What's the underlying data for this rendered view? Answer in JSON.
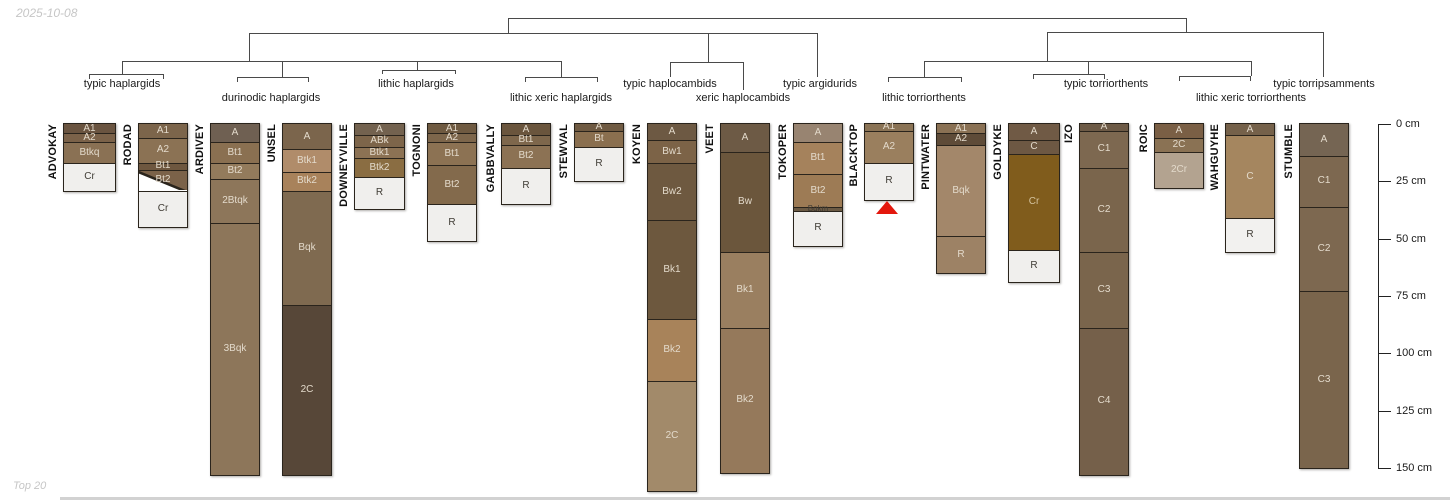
{
  "watermarks": {
    "top_left": "2025-10-08",
    "bottom_left": "Top 20"
  },
  "chart_data": {
    "type": "soil-horizon-dendrogram",
    "depth_axis": {
      "unit": "cm",
      "min": 0,
      "max": 150,
      "ticks": [
        {
          "cm": 0,
          "label": "0 cm"
        },
        {
          "cm": 25,
          "label": "25 cm"
        },
        {
          "cm": 50,
          "label": "50 cm"
        },
        {
          "cm": 75,
          "label": "75 cm"
        },
        {
          "cm": 100,
          "label": "100 cm"
        },
        {
          "cm": 125,
          "label": "125 cm"
        },
        {
          "cm": 150,
          "label": "150 cm"
        }
      ]
    },
    "groups": [
      {
        "label": "typic haplargids",
        "cx": 122,
        "row": 1,
        "series": [
          "ADVOKAY",
          "RODAD"
        ]
      },
      {
        "label": "durinodic haplargids",
        "cx": 271,
        "row": 2,
        "series": [
          "ARDIVEY",
          "UNSEL"
        ]
      },
      {
        "label": "lithic haplargids",
        "cx": 416,
        "row": 1,
        "series": [
          "DOWNEYVILLE",
          "TOGNONI"
        ]
      },
      {
        "label": "lithic xeric haplargids",
        "cx": 561,
        "row": 2,
        "series": [
          "GABBVALLY",
          "STEWVAL"
        ]
      },
      {
        "label": "typic haplocambids",
        "cx": 670,
        "row": 1,
        "series": [
          "KOYEN"
        ]
      },
      {
        "label": "xeric haplocambids",
        "cx": 743,
        "row": 2,
        "series": [
          "VEET"
        ]
      },
      {
        "label": "typic argidurids",
        "cx": 820,
        "row": 1,
        "series": [
          "TOKOPER"
        ]
      },
      {
        "label": "lithic torriorthents",
        "cx": 924,
        "row": 2,
        "series": [
          "BLACKTOP",
          "PINTWATER"
        ]
      },
      {
        "label": "typic torriorthents",
        "cx": 1106,
        "row": 1,
        "series": [
          "GOLDYKE",
          "IZO"
        ]
      },
      {
        "label": "lithic xeric torriorthents",
        "cx": 1251,
        "row": 2,
        "series": [
          "ROIC",
          "WAHGUYHE"
        ]
      },
      {
        "label": "typic torripsamments",
        "cx": 1324,
        "row": 1,
        "series": [
          "STUMBLE"
        ]
      }
    ],
    "series": [
      {
        "name": "ADVOKAY",
        "x": 64,
        "w": 51,
        "horizons": [
          {
            "h": "A1",
            "t": 0,
            "b": 4,
            "c": "#6a5440",
            "tc": "light"
          },
          {
            "h": "A2",
            "t": 4,
            "b": 8,
            "c": "#7b6249",
            "tc": "light"
          },
          {
            "h": "Btkq",
            "t": 8,
            "b": 17,
            "c": "#8a7154",
            "tc": "light"
          },
          {
            "h": "Cr",
            "t": 17,
            "b": 29,
            "c": "#f0efed",
            "tc": "dark"
          }
        ]
      },
      {
        "name": "RODAD",
        "x": 139,
        "w": 48,
        "horizons": [
          {
            "h": "A1",
            "t": 0,
            "b": 6,
            "c": "#7c654b",
            "tc": "light"
          },
          {
            "h": "A2",
            "t": 6,
            "b": 17,
            "c": "#8b7254",
            "tc": "light"
          },
          {
            "h": "Bt1",
            "t": 17,
            "b": 20,
            "c": "#6e573f",
            "tc": "light"
          },
          {
            "h": "Bt2",
            "t": 20,
            "b": 29,
            "c": "#7b6249",
            "tc": "light",
            "cut": true
          },
          {
            "h": "Cr",
            "t": 29,
            "b": 45,
            "c": "#f0efed",
            "tc": "dark"
          }
        ]
      },
      {
        "name": "ARDIVEY",
        "x": 211,
        "w": 48,
        "horizons": [
          {
            "h": "A",
            "t": 0,
            "b": 8,
            "c": "#6f6052",
            "tc": "light"
          },
          {
            "h": "Bt1",
            "t": 8,
            "b": 17,
            "c": "#8a7051",
            "tc": "light"
          },
          {
            "h": "Bt2",
            "t": 17,
            "b": 24,
            "c": "#937b5c",
            "tc": "light"
          },
          {
            "h": "2Btqk",
            "t": 24,
            "b": 43,
            "c": "#8d765a",
            "tc": "light"
          },
          {
            "h": "3Bqk",
            "t": 43,
            "b": 153,
            "c": "#8d765a",
            "tc": "light"
          }
        ]
      },
      {
        "name": "UNSEL",
        "x": 283,
        "w": 48,
        "horizons": [
          {
            "h": "A",
            "t": 0,
            "b": 11,
            "c": "#7b654c",
            "tc": "light"
          },
          {
            "h": "Btk1",
            "t": 11,
            "b": 21,
            "c": "#b08c6a",
            "tc": "light"
          },
          {
            "h": "Btk2",
            "t": 21,
            "b": 29,
            "c": "#a8825b",
            "tc": "light"
          },
          {
            "h": "Bqk",
            "t": 29,
            "b": 79,
            "c": "#7f6a50",
            "tc": "light"
          },
          {
            "h": "2C",
            "t": 79,
            "b": 153,
            "c": "#574738",
            "tc": "light"
          }
        ]
      },
      {
        "name": "DOWNEYVILLE",
        "x": 355,
        "w": 49,
        "horizons": [
          {
            "h": "A",
            "t": 0,
            "b": 5,
            "c": "#73624f",
            "tc": "light"
          },
          {
            "h": "ABk",
            "t": 5,
            "b": 10,
            "c": "#7d654a",
            "tc": "light"
          },
          {
            "h": "Btk1",
            "t": 10,
            "b": 15,
            "c": "#8c7254",
            "tc": "light"
          },
          {
            "h": "Btk2",
            "t": 15,
            "b": 23,
            "c": "#8a6d42",
            "tc": "light"
          },
          {
            "h": "R",
            "t": 23,
            "b": 37,
            "c": "#f0efed",
            "tc": "dark"
          }
        ]
      },
      {
        "name": "TOGNONI",
        "x": 428,
        "w": 48,
        "horizons": [
          {
            "h": "A1",
            "t": 0,
            "b": 4,
            "c": "#6f5a41",
            "tc": "light"
          },
          {
            "h": "A2",
            "t": 4,
            "b": 8,
            "c": "#7d664b",
            "tc": "light"
          },
          {
            "h": "Bt1",
            "t": 8,
            "b": 18,
            "c": "#8c7253",
            "tc": "light"
          },
          {
            "h": "Bt2",
            "t": 18,
            "b": 35,
            "c": "#836a4c",
            "tc": "light"
          },
          {
            "h": "R",
            "t": 35,
            "b": 51,
            "c": "#f0efed",
            "tc": "dark"
          }
        ]
      },
      {
        "name": "GABBVALLY",
        "x": 502,
        "w": 48,
        "horizons": [
          {
            "h": "A",
            "t": 0,
            "b": 5,
            "c": "#6a553d",
            "tc": "light"
          },
          {
            "h": "Bt1",
            "t": 5,
            "b": 9,
            "c": "#7e674c",
            "tc": "light"
          },
          {
            "h": "Bt2",
            "t": 9,
            "b": 19,
            "c": "#8c7254",
            "tc": "light"
          },
          {
            "h": "R",
            "t": 19,
            "b": 35,
            "c": "#f0efed",
            "tc": "dark"
          }
        ]
      },
      {
        "name": "STEWVAL",
        "x": 575,
        "w": 48,
        "horizons": [
          {
            "h": "A",
            "t": 0,
            "b": 3,
            "c": "#6f5a42",
            "tc": "light"
          },
          {
            "h": "Bt",
            "t": 3,
            "b": 10,
            "c": "#8a6f4f",
            "tc": "light"
          },
          {
            "h": "R",
            "t": 10,
            "b": 25,
            "c": "#f0efed",
            "tc": "dark"
          }
        ]
      },
      {
        "name": "KOYEN",
        "x": 648,
        "w": 48,
        "horizons": [
          {
            "h": "A",
            "t": 0,
            "b": 7,
            "c": "#6d5943",
            "tc": "light"
          },
          {
            "h": "Bw1",
            "t": 7,
            "b": 17,
            "c": "#7c6347",
            "tc": "light"
          },
          {
            "h": "Bw2",
            "t": 17,
            "b": 42,
            "c": "#6e5940",
            "tc": "light"
          },
          {
            "h": "Bk1",
            "t": 42,
            "b": 85,
            "c": "#6d583e",
            "tc": "light"
          },
          {
            "h": "Bk2",
            "t": 85,
            "b": 112,
            "c": "#a8835a",
            "tc": "light"
          },
          {
            "h": "2C",
            "t": 112,
            "b": 160,
            "c": "#a28a6a",
            "tc": "light"
          }
        ]
      },
      {
        "name": "VEET",
        "x": 721,
        "w": 48,
        "horizons": [
          {
            "h": "A",
            "t": 0,
            "b": 12,
            "c": "#6d5a45",
            "tc": "light"
          },
          {
            "h": "Bw",
            "t": 12,
            "b": 56,
            "c": "#6b563c",
            "tc": "light"
          },
          {
            "h": "Bk1",
            "t": 56,
            "b": 89,
            "c": "#9a7f60",
            "tc": "light"
          },
          {
            "h": "Bk2",
            "t": 89,
            "b": 152,
            "c": "#95795b",
            "tc": "light"
          }
        ]
      },
      {
        "name": "TOKOPER",
        "x": 794,
        "w": 48,
        "horizons": [
          {
            "h": "A",
            "t": 0,
            "b": 8,
            "c": "#988471",
            "tc": "light"
          },
          {
            "h": "Bt1",
            "t": 8,
            "b": 22,
            "c": "#a5825c",
            "tc": "light"
          },
          {
            "h": "Bt2",
            "t": 22,
            "b": 36,
            "c": "#9d7b55",
            "tc": "light"
          },
          {
            "h": "Bqkm",
            "t": 36,
            "b": 38,
            "c": "#6b5a44",
            "tc": "dark",
            "small": true
          },
          {
            "h": "R",
            "t": 38,
            "b": 53,
            "c": "#f0efed",
            "tc": "dark"
          }
        ]
      },
      {
        "name": "BLACKTOP",
        "x": 865,
        "w": 48,
        "horizons": [
          {
            "h": "A1",
            "t": 0,
            "b": 3,
            "c": "#8a7355",
            "tc": "light"
          },
          {
            "h": "A2",
            "t": 3,
            "b": 17,
            "c": "#9a7f5e",
            "tc": "light"
          },
          {
            "h": "R",
            "t": 17,
            "b": 33,
            "c": "#f0efed",
            "tc": "dark"
          }
        ]
      },
      {
        "name": "PINTWATER",
        "x": 937,
        "w": 48,
        "horizons": [
          {
            "h": "A1",
            "t": 0,
            "b": 4,
            "c": "#8a7154",
            "tc": "light"
          },
          {
            "h": "A2",
            "t": 4,
            "b": 9,
            "c": "#5e4b38",
            "tc": "light"
          },
          {
            "h": "Bqk",
            "t": 9,
            "b": 49,
            "c": "#a3876a",
            "tc": "light"
          },
          {
            "h": "R",
            "t": 49,
            "b": 65,
            "c": "#9d8265",
            "tc": "light"
          }
        ]
      },
      {
        "name": "GOLDYKE",
        "x": 1009,
        "w": 50,
        "horizons": [
          {
            "h": "A",
            "t": 0,
            "b": 7,
            "c": "#705a45",
            "tc": "light"
          },
          {
            "h": "C",
            "t": 7,
            "b": 13,
            "c": "#6d5843",
            "tc": "light"
          },
          {
            "h": "Cr",
            "t": 13,
            "b": 55,
            "c": "#805c1c",
            "tc": "#d4c39e"
          },
          {
            "h": "R",
            "t": 55,
            "b": 69,
            "c": "#f0efed",
            "tc": "dark"
          }
        ]
      },
      {
        "name": "IZO",
        "x": 1080,
        "w": 48,
        "horizons": [
          {
            "h": "A",
            "t": 0,
            "b": 3,
            "c": "#6d5a46",
            "tc": "light"
          },
          {
            "h": "C1",
            "t": 3,
            "b": 19,
            "c": "#7d6850",
            "tc": "light"
          },
          {
            "h": "C2",
            "t": 19,
            "b": 56,
            "c": "#7a654c",
            "tc": "light"
          },
          {
            "h": "C3",
            "t": 56,
            "b": 89,
            "c": "#7a654c",
            "tc": "light"
          },
          {
            "h": "C4",
            "t": 89,
            "b": 153,
            "c": "#75604a",
            "tc": "light"
          }
        ]
      },
      {
        "name": "ROIC",
        "x": 1155,
        "w": 48,
        "horizons": [
          {
            "h": "A",
            "t": 0,
            "b": 6,
            "c": "#7a5f45",
            "tc": "light"
          },
          {
            "h": "2C",
            "t": 6,
            "b": 12,
            "c": "#8a7254",
            "tc": "light"
          },
          {
            "h": "2Cr",
            "t": 12,
            "b": 28,
            "c": "#b3a390",
            "tc": "light"
          }
        ]
      },
      {
        "name": "WAHGUYHE",
        "x": 1226,
        "w": 48,
        "horizons": [
          {
            "h": "A",
            "t": 0,
            "b": 5,
            "c": "#75614a",
            "tc": "light"
          },
          {
            "h": "C",
            "t": 5,
            "b": 41,
            "c": "#a5865f",
            "tc": "light"
          },
          {
            "h": "R",
            "t": 41,
            "b": 56,
            "c": "#f2f1ef",
            "tc": "dark"
          }
        ]
      },
      {
        "name": "STUMBLE",
        "x": 1300,
        "w": 48,
        "horizons": [
          {
            "h": "A",
            "t": 0,
            "b": 14,
            "c": "#756553",
            "tc": "light"
          },
          {
            "h": "C1",
            "t": 14,
            "b": 36,
            "c": "#7d6850",
            "tc": "light"
          },
          {
            "h": "C2",
            "t": 36,
            "b": 73,
            "c": "#7d6850",
            "tc": "light"
          },
          {
            "h": "C3",
            "t": 73,
            "b": 150,
            "c": "#7a654c",
            "tc": "light"
          }
        ]
      }
    ],
    "dendrogram": {
      "color": "#4a4a4a",
      "segments": [
        [
          508,
          18,
          1186,
          18
        ],
        [
          508,
          18,
          508,
          33
        ],
        [
          1186,
          18,
          1186,
          32
        ],
        [
          249,
          33,
          817,
          33
        ],
        [
          249,
          33,
          249,
          61
        ],
        [
          708,
          33,
          708,
          62
        ],
        [
          817,
          33,
          817,
          77
        ],
        [
          122,
          61,
          561,
          61
        ],
        [
          122,
          61,
          122,
          74
        ],
        [
          282,
          61,
          282,
          77
        ],
        [
          417,
          61,
          417,
          70
        ],
        [
          561,
          61,
          561,
          77
        ],
        [
          89,
          74,
          163,
          74
        ],
        [
          89,
          74,
          89,
          79
        ],
        [
          163,
          74,
          163,
          79
        ],
        [
          237,
          77,
          308,
          77
        ],
        [
          237,
          77,
          237,
          82
        ],
        [
          308,
          77,
          308,
          82
        ],
        [
          382,
          70,
          455,
          70
        ],
        [
          382,
          70,
          382,
          74
        ],
        [
          455,
          70,
          455,
          74
        ],
        [
          525,
          77,
          597,
          77
        ],
        [
          525,
          77,
          525,
          82
        ],
        [
          597,
          77,
          597,
          82
        ],
        [
          670,
          62,
          743,
          62
        ],
        [
          670,
          62,
          670,
          77
        ],
        [
          743,
          62,
          743,
          90
        ],
        [
          1047,
          32,
          1323,
          32
        ],
        [
          1047,
          32,
          1047,
          61
        ],
        [
          1323,
          32,
          1323,
          77
        ],
        [
          924,
          61,
          1251,
          61
        ],
        [
          924,
          61,
          924,
          77
        ],
        [
          1088,
          61,
          1088,
          74
        ],
        [
          1251,
          61,
          1251,
          76
        ],
        [
          888,
          77,
          961,
          77
        ],
        [
          888,
          77,
          888,
          82
        ],
        [
          961,
          77,
          961,
          82
        ],
        [
          1033,
          74,
          1104,
          74
        ],
        [
          1033,
          74,
          1033,
          79
        ],
        [
          1104,
          74,
          1104,
          79
        ],
        [
          1179,
          76,
          1250,
          76
        ],
        [
          1179,
          76,
          1179,
          81
        ],
        [
          1250,
          76,
          1250,
          81
        ]
      ]
    },
    "annotations": [
      {
        "type": "red-triangle",
        "series": "BLACKTOP",
        "x": 876,
        "y": 201,
        "w": 22,
        "h": 13,
        "color": "#e3170d"
      }
    ],
    "layout": {
      "col_top": 124,
      "px_per_cm": 2.2933,
      "axis_x": 1378,
      "axis_tick_len": 13,
      "axis_label_x": 1396,
      "group_row1_y": 78,
      "group_row2_y": 92,
      "text_light": "#e3dacb",
      "text_dark": "#3f3b34"
    }
  }
}
